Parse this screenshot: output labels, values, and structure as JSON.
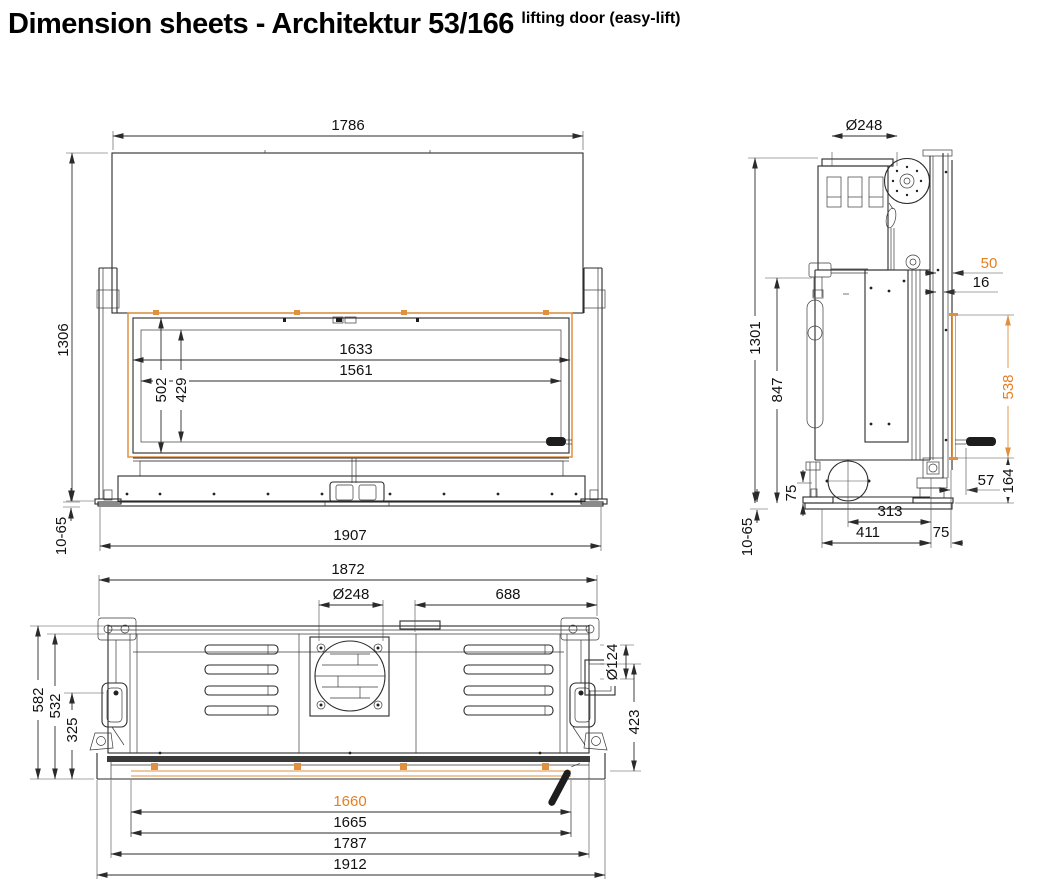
{
  "title": {
    "main": "Dimension sheets - Architektur 53/166",
    "superscript": "lifting door (easy-lift)"
  },
  "colors": {
    "line": "#2b2b2b",
    "orange": "#e0913f",
    "orange_text": "#e67e22"
  },
  "front_view": {
    "overall_width": "1786",
    "overall_height": "1306",
    "glass_frame_width": "1633",
    "glass_width": "1561",
    "glass_frame_height": "502",
    "glass_height": "429",
    "base_width": "1907",
    "floor_clearance": "10-65"
  },
  "side_view": {
    "flue_diameter": "Ø248",
    "front_offset": "50",
    "front_gap": "16",
    "overall_height": "1301",
    "body_height": "847",
    "door_lift_height": "538",
    "handle_offset": "57",
    "plinth_height": "164",
    "foot_height": "75",
    "intake_depth": "313",
    "base_depth": "411",
    "front_depth": "75",
    "floor_clearance": "10-65"
  },
  "top_view": {
    "body_width": "1872",
    "flue_diameter": "Ø248",
    "flue_to_right": "688",
    "overall_depth": "582",
    "body_depth": "532",
    "front_frame_depth": "325",
    "intake_diameter": "Ø124",
    "right_depth": "423",
    "glass_width": "1660",
    "door_inner_width": "1665",
    "frame_width": "1787",
    "overall_width": "1912"
  }
}
